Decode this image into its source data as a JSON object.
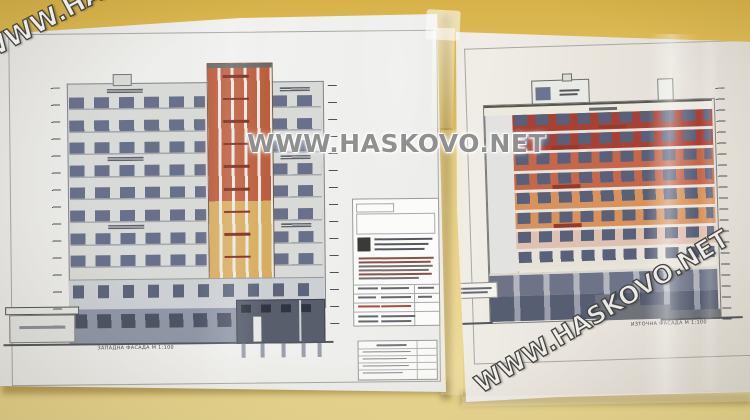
{
  "watermarks": {
    "text": "WWW.HASKOVO.NET"
  },
  "wall": {
    "top_color": "#d7b249",
    "bottom_color": "#ead892"
  },
  "paper_color": "#efeeec",
  "left_sheet": {
    "caption": "ЗАПАДНА ФАСАДА  М 1:100",
    "building": {
      "typical_floors": 8,
      "wall_color": "#d8dad7",
      "window_color": "#69718a",
      "tower_top_color": "#bc5e3e",
      "tower_bottom_color": "#d7ad60",
      "tower_mullion_color": "#eae8e2",
      "tower_label_color": "#7c2a1c",
      "mezzanine_color": "#ccd0d3",
      "ground_color": "#9098a7",
      "basement_color": "#585e6c"
    }
  },
  "right_sheet": {
    "caption": "ИЗТОЧНА ФАСАДА  М 1:100",
    "building": {
      "floors": 8,
      "band_colors": [
        "#a84034",
        "#a84034",
        "#c4674a",
        "#c4674a",
        "#d8935c",
        "#d8935c",
        "#dfc1b2",
        "#e7e2d8"
      ],
      "window_color": "#58607a",
      "slab_color": "#e8e4da",
      "label_color": "#97392c",
      "parapet_color": "#eceade",
      "end_wall_color": "#e2e3e0",
      "ground_glazing_dark": "#565e72",
      "ground_glazing_mid": "#6d7488",
      "terrain_color": "#6e727b"
    }
  }
}
